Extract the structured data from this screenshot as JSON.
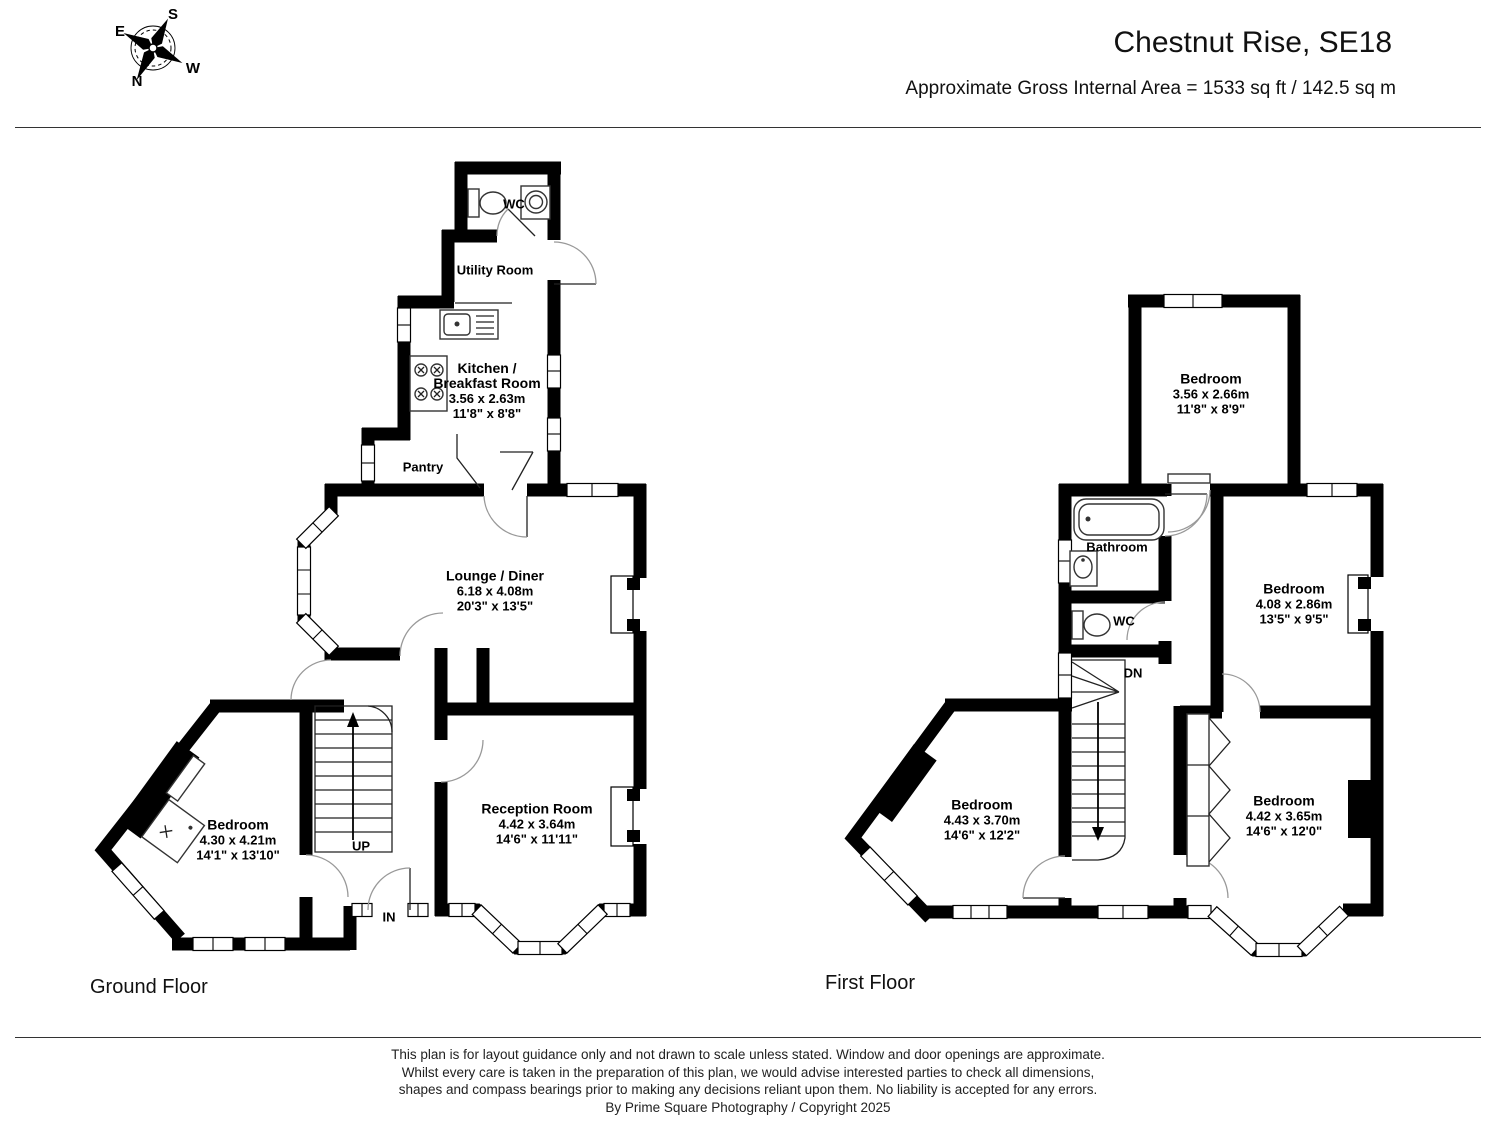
{
  "header": {
    "title": "Chestnut Rise, SE18",
    "subtitle": "Approximate Gross Internal Area = 1533 sq ft / 142.5 sq m"
  },
  "compass": {
    "north": "N",
    "south": "S",
    "east": "E",
    "west": "W"
  },
  "ground_floor": {
    "label": "Ground Floor",
    "stairs_label": "UP",
    "entrance_label": "IN",
    "rooms": {
      "wc": {
        "name": "WC"
      },
      "utility": {
        "name": "Utility Room"
      },
      "kitchen": {
        "name_lines": [
          "Kitchen /",
          "Breakfast Room"
        ],
        "metric": "3.56 x 2.63m",
        "imperial": "11'8\" x 8'8\""
      },
      "pantry": {
        "name": "Pantry"
      },
      "lounge": {
        "name": "Lounge / Diner",
        "metric": "6.18 x 4.08m",
        "imperial": "20'3\" x 13'5\""
      },
      "bedroom": {
        "name": "Bedroom",
        "metric": "4.30 x 4.21m",
        "imperial": "14'1\" x 13'10\""
      },
      "reception": {
        "name": "Reception Room",
        "metric": "4.42 x 3.64m",
        "imperial": "14'6\" x 11'11\""
      }
    }
  },
  "first_floor": {
    "label": "First Floor",
    "stairs_label": "DN",
    "rooms": {
      "bedroom_top": {
        "name": "Bedroom",
        "metric": "3.56 x 2.66m",
        "imperial": "11'8\" x 8'9\""
      },
      "bathroom": {
        "name": "Bathroom"
      },
      "wc": {
        "name": "WC"
      },
      "bedroom_right": {
        "name": "Bedroom",
        "metric": "4.08 x 2.86m",
        "imperial": "13'5\" x 9'5\""
      },
      "bedroom_left": {
        "name": "Bedroom",
        "metric": "4.43 x 3.70m",
        "imperial": "14'6\" x 12'2\""
      },
      "bedroom_bottom": {
        "name": "Bedroom",
        "metric": "4.42 x 3.65m",
        "imperial": "14'6\" x 12'0\""
      }
    }
  },
  "footer": {
    "lines": [
      "This plan is for layout guidance only and not drawn to scale unless stated. Window and door openings are approximate.",
      "Whilst every care is taken in the preparation of this plan, we would advise interested parties to check all dimensions,",
      "shapes and compass bearings prior to making any decisions reliant upon them. No liability is accepted for any errors.",
      "By Prime Square Photography / Copyright 2025"
    ]
  }
}
